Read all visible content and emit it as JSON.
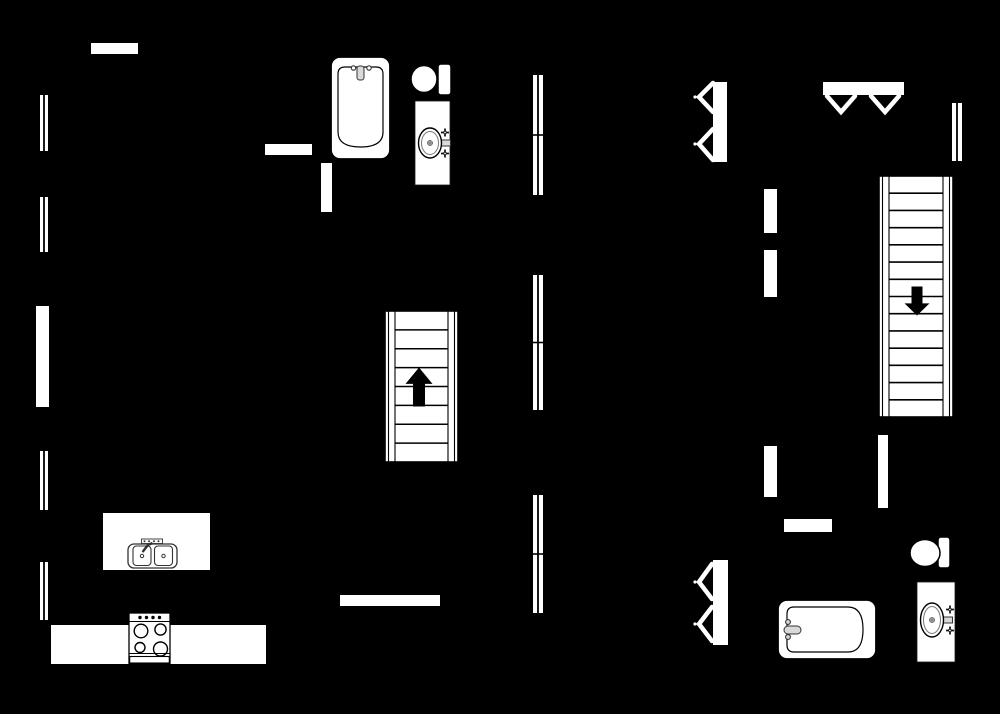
{
  "canvas": {
    "width": 1000,
    "height": 714,
    "background": "#000000",
    "fixture_fill": "#ffffff",
    "line": "#000000",
    "detail_gray": "#555555",
    "light_gray": "#d9d9d9"
  },
  "plan": {
    "elements": [
      {
        "type": "wall",
        "name": "wall-opening-top-left",
        "x": 91,
        "y": 43,
        "w": 47,
        "h": 11
      },
      {
        "type": "wall",
        "name": "wall-segment-bath1-left",
        "x": 265,
        "y": 144,
        "w": 47,
        "h": 11
      },
      {
        "type": "wall",
        "name": "wall-segment-bath1-bottom",
        "x": 321,
        "y": 163,
        "w": 11,
        "h": 49
      },
      {
        "type": "wall",
        "name": "wall-segment-left-mid",
        "x": 36,
        "y": 306,
        "w": 13,
        "h": 101
      },
      {
        "type": "wall",
        "name": "wall-segment-right-a",
        "x": 764,
        "y": 189,
        "w": 13,
        "h": 44
      },
      {
        "type": "wall",
        "name": "wall-segment-right-b",
        "x": 764,
        "y": 250,
        "w": 13,
        "h": 47
      },
      {
        "type": "wall",
        "name": "wall-segment-right-c",
        "x": 764,
        "y": 446,
        "w": 13,
        "h": 51
      },
      {
        "type": "wall",
        "name": "wall-segment-stair-bottom",
        "x": 878,
        "y": 435,
        "w": 10,
        "h": 73
      },
      {
        "type": "wall",
        "name": "wall-segment-bath2-top",
        "x": 784,
        "y": 519,
        "w": 48,
        "h": 13
      },
      {
        "type": "wall",
        "name": "wall-segment-center-bottom",
        "x": 340,
        "y": 595,
        "w": 100,
        "h": 11
      },
      {
        "type": "wall",
        "name": "kitchen-island",
        "x": 103,
        "y": 513,
        "w": 107,
        "h": 57
      },
      {
        "type": "wall",
        "name": "kitchen-counter",
        "x": 51,
        "y": 625,
        "w": 215,
        "h": 39
      },
      {
        "type": "window",
        "name": "window-left-1",
        "x": 40,
        "y": 95,
        "w": 8,
        "h": 56,
        "divided": false
      },
      {
        "type": "window",
        "name": "window-left-2",
        "x": 40,
        "y": 197,
        "w": 8,
        "h": 55,
        "divided": false
      },
      {
        "type": "window",
        "name": "window-left-3",
        "x": 40,
        "y": 451,
        "w": 8,
        "h": 59,
        "divided": false
      },
      {
        "type": "window",
        "name": "window-left-4",
        "x": 40,
        "y": 562,
        "w": 8,
        "h": 58,
        "divided": false
      },
      {
        "type": "window",
        "name": "window-center-1",
        "x": 533,
        "y": 75,
        "w": 10,
        "h": 120,
        "divided": true
      },
      {
        "type": "window",
        "name": "window-center-2",
        "x": 533,
        "y": 275,
        "w": 10,
        "h": 135,
        "divided": true
      },
      {
        "type": "window",
        "name": "window-center-3",
        "x": 533,
        "y": 495,
        "w": 10,
        "h": 118,
        "divided": true
      },
      {
        "type": "window",
        "name": "window-right-1",
        "x": 952,
        "y": 103,
        "w": 10,
        "h": 58,
        "divided": false
      },
      {
        "type": "stairs",
        "name": "staircase-up",
        "x": 385,
        "y": 311,
        "w": 73,
        "h": 151,
        "dir": "up",
        "treads": 7,
        "arrow": {
          "cx": 419,
          "cy": 387,
          "len": 39,
          "head": 27,
          "shaft": 12
        }
      },
      {
        "type": "stairs",
        "name": "staircase-down",
        "x": 879,
        "y": 176,
        "w": 74,
        "h": 241,
        "dir": "down",
        "treads": 13,
        "arrow": {
          "cx": 917,
          "cy": 301,
          "len": 29,
          "head": 25,
          "shaft": 11
        }
      },
      {
        "type": "folding-door",
        "name": "bifold-closet-door-upper",
        "bar": [
          713,
          82,
          14,
          80
        ],
        "strokes": [
          [
            [
              713,
              83
            ],
            [
              699,
              97
            ],
            [
              713,
              112
            ]
          ],
          [
            [
              713,
              129
            ],
            [
              699,
              144
            ],
            [
              713,
              160
            ]
          ]
        ],
        "dots": [
          [
            695,
            97
          ],
          [
            695,
            144
          ]
        ]
      },
      {
        "type": "folding-door",
        "name": "bifold-closet-door-lower",
        "bar": [
          713,
          560,
          15,
          85
        ],
        "strokes": [
          [
            [
              712,
              564
            ],
            [
              699,
              582
            ],
            [
              712,
              599
            ]
          ],
          [
            [
              712,
              607
            ],
            [
              699,
              624
            ],
            [
              712,
              641
            ]
          ]
        ],
        "dots": [
          [
            695,
            582
          ],
          [
            695,
            624
          ]
        ]
      },
      {
        "type": "folding-door",
        "name": "double-folding-door-top",
        "bar": [
          823,
          82,
          81,
          13
        ],
        "strokes": [
          [
            [
              827,
              96
            ],
            [
              841,
              112
            ],
            [
              855,
              96
            ]
          ],
          [
            [
              871,
              96
            ],
            [
              885,
              112
            ],
            [
              899,
              96
            ]
          ]
        ],
        "dots": []
      },
      {
        "type": "bathtub",
        "name": "bathtub-upper",
        "x": 331,
        "y": 57,
        "w": 59,
        "h": 102,
        "orient": "v"
      },
      {
        "type": "bathtub",
        "name": "bathtub-lower",
        "x": 778,
        "y": 600,
        "w": 98,
        "h": 59,
        "orient": "h"
      },
      {
        "type": "toilet",
        "name": "toilet-upper",
        "bowl": {
          "cx": 424,
          "cy": 79,
          "rx": 13,
          "ry": 13.5
        },
        "tank": {
          "x": 438,
          "y": 64,
          "w": 13,
          "h": 31
        }
      },
      {
        "type": "toilet",
        "name": "toilet-lower",
        "bowl": {
          "cx": 925,
          "cy": 553,
          "rx": 15,
          "ry": 13.5
        },
        "tank": {
          "x": 938,
          "y": 537,
          "w": 12,
          "h": 31
        }
      },
      {
        "type": "sink",
        "name": "bathroom-sink-upper",
        "x": 415,
        "y": 101,
        "w": 35,
        "h": 84,
        "basin": {
          "cx": 430,
          "cy": 143,
          "rx": 11.5,
          "ry": 15
        }
      },
      {
        "type": "sink",
        "name": "bathroom-sink-lower",
        "x": 917,
        "y": 582,
        "w": 38,
        "h": 80,
        "basin": {
          "cx": 932,
          "cy": 620,
          "rx": 11.5,
          "ry": 17
        }
      },
      {
        "type": "kitchen-sink",
        "name": "kitchen-sink",
        "x": 128,
        "y": 537,
        "w": 49,
        "h": 31
      },
      {
        "type": "stove",
        "name": "stove",
        "x": 129,
        "y": 613,
        "w": 41,
        "h": 51
      }
    ]
  }
}
